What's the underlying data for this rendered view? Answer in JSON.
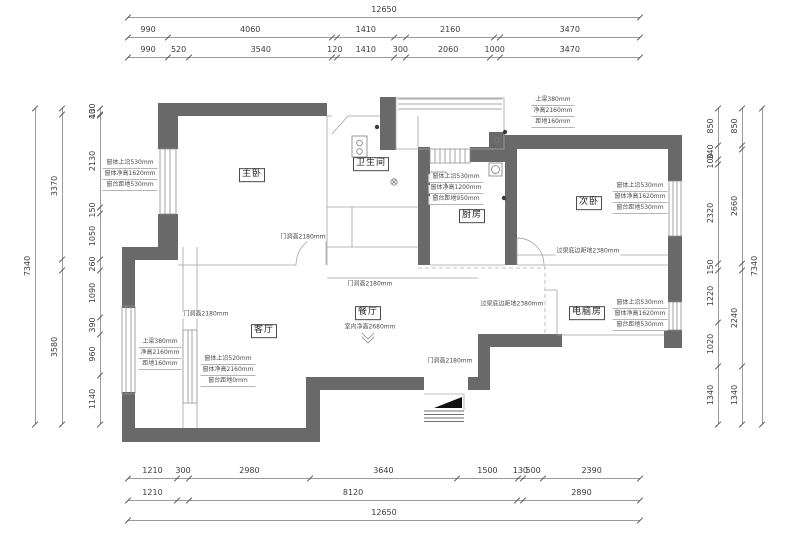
{
  "drawing": {
    "overall_width_mm": "12650",
    "overall_height_mm": "7340"
  },
  "colors": {
    "wall": "#696969",
    "thin_line": "#a3a3a3",
    "dim_line": "#9b9b9b",
    "dim_text": "#3c3c3c",
    "annotation_text": "#4a4a4a"
  },
  "rooms": [
    {
      "name": "master-bedroom",
      "label": "主卧",
      "x": 252,
      "y": 175
    },
    {
      "name": "bathroom",
      "label": "卫生间",
      "x": 371,
      "y": 164
    },
    {
      "name": "kitchen",
      "label": "厨房",
      "x": 472,
      "y": 216
    },
    {
      "name": "second-bedroom",
      "label": "次卧",
      "x": 589,
      "y": 203
    },
    {
      "name": "living-room",
      "label": "客厅",
      "x": 264,
      "y": 331
    },
    {
      "name": "dining-room",
      "label": "餐厅",
      "x": 368,
      "y": 313
    },
    {
      "name": "computer-room",
      "label": "电脑房",
      "x": 587,
      "y": 313
    }
  ],
  "annotations": [
    {
      "name": "master-window",
      "x": 130,
      "y": 160,
      "lines": [
        "窗体上沿530mm",
        "窗体净高1620mm",
        "窗台距地530mm"
      ]
    },
    {
      "name": "kitchen-window",
      "x": 456,
      "y": 174,
      "lines": [
        "窗体上沿530mm",
        "窗体净高1200mm",
        "窗台距地950mm"
      ]
    },
    {
      "name": "second-bedroom-window",
      "x": 640,
      "y": 183,
      "lines": [
        "窗体上沿530mm",
        "窗体净高1620mm",
        "窗台距地530mm"
      ]
    },
    {
      "name": "computer-room-window",
      "x": 640,
      "y": 300,
      "lines": [
        "窗体上沿530mm",
        "窗体净高1620mm",
        "窗台距地530mm"
      ]
    },
    {
      "name": "living-room-beam",
      "x": 160,
      "y": 339,
      "lines": [
        "上梁380mm",
        "净高2160mm",
        "距地160mm"
      ]
    },
    {
      "name": "living-room-window",
      "x": 228,
      "y": 356,
      "lines": [
        "窗体上沿520mm",
        "窗体净高2160mm",
        "窗台距地0mm"
      ]
    },
    {
      "name": "balcony-beam",
      "x": 553,
      "y": 97,
      "lines": [
        "上梁380mm",
        "净高2160mm",
        "距地160mm"
      ]
    }
  ],
  "notes": [
    {
      "name": "door-height-master",
      "label": "门洞高2180mm",
      "x": 303,
      "y": 238
    },
    {
      "name": "door-height-hall",
      "label": "门洞高2180mm",
      "x": 370,
      "y": 285
    },
    {
      "name": "door-height-living",
      "label": "门洞高2180mm",
      "x": 206,
      "y": 315
    },
    {
      "name": "door-height-entry",
      "label": "门洞高2180mm",
      "x": 450,
      "y": 362
    },
    {
      "name": "lintel-clearance-1",
      "label": "过梁底边距地2380mm",
      "x": 588,
      "y": 252
    },
    {
      "name": "lintel-clearance-2",
      "label": "过梁底边距地2380mm",
      "x": 512,
      "y": 305
    },
    {
      "name": "ceiling-height",
      "label": "室内净高2680mm",
      "x": 370,
      "y": 328
    }
  ],
  "dimensions": {
    "top_rows": [
      {
        "name": "top-row-overall",
        "x": 128,
        "y": 6,
        "w": 512,
        "segs": [
          {
            "v": 12650,
            "t": "12650"
          }
        ]
      },
      {
        "name": "top-row-main",
        "x": 128,
        "y": 26,
        "w": 512,
        "segs": [
          {
            "v": 990,
            "t": "990"
          },
          {
            "v": 4060,
            "t": "4060"
          },
          {
            "v": 120,
            "t": ""
          },
          {
            "v": 1410,
            "t": "1410"
          },
          {
            "v": 300,
            "t": ""
          },
          {
            "v": 2160,
            "t": "2160"
          },
          {
            "v": 140,
            "t": ""
          },
          {
            "v": 3470,
            "t": "3470"
          }
        ]
      },
      {
        "name": "top-row-detail",
        "x": 128,
        "y": 46,
        "w": 512,
        "segs": [
          {
            "v": 990,
            "t": "990"
          },
          {
            "v": 520,
            "t": "520"
          },
          {
            "v": 3540,
            "t": "3540"
          },
          {
            "v": 120,
            "t": "120"
          },
          {
            "v": 1410,
            "t": "1410"
          },
          {
            "v": 300,
            "t": "300"
          },
          {
            "v": 2060,
            "t": "2060"
          },
          {
            "v": 240,
            "t": "1000"
          },
          {
            "v": 3470,
            "t": "3470"
          }
        ]
      }
    ],
    "bottom_rows": [
      {
        "name": "bottom-row-detail",
        "x": 128,
        "y": 467,
        "w": 512,
        "segs": [
          {
            "v": 1210,
            "t": "1210"
          },
          {
            "v": 300,
            "t": "300"
          },
          {
            "v": 2980,
            "t": "2980"
          },
          {
            "v": 3640,
            "t": "3640"
          },
          {
            "v": 1500,
            "t": "1500"
          },
          {
            "v": 130,
            "t": "130"
          },
          {
            "v": 500,
            "t": "500"
          },
          {
            "v": 2390,
            "t": "2390"
          }
        ]
      },
      {
        "name": "bottom-row-main",
        "x": 128,
        "y": 489,
        "w": 512,
        "segs": [
          {
            "v": 1210,
            "t": "1210"
          },
          {
            "v": 290,
            "t": ""
          },
          {
            "v": 8120,
            "t": "8120"
          },
          {
            "v": 140,
            "t": ""
          },
          {
            "v": 2890,
            "t": "2890"
          }
        ]
      },
      {
        "name": "bottom-row-overall",
        "x": 128,
        "y": 509,
        "w": 512,
        "segs": [
          {
            "v": 12650,
            "t": "12650"
          }
        ]
      }
    ],
    "left_cols": [
      {
        "name": "left-col-overall",
        "x": 35,
        "y": 108,
        "h": 316,
        "segs": [
          {
            "v": 7340,
            "t": "7340"
          }
        ]
      },
      {
        "name": "left-col-main",
        "x": 62,
        "y": 108,
        "h": 316,
        "segs": [
          {
            "v": 130,
            "t": ""
          },
          {
            "v": 3370,
            "t": "3370"
          },
          {
            "v": 260,
            "t": ""
          },
          {
            "v": 3580,
            "t": "3580"
          }
        ]
      },
      {
        "name": "left-col-detail",
        "x": 100,
        "y": 108,
        "h": 316,
        "segs": [
          {
            "v": 130,
            "t": "130"
          },
          {
            "v": 40,
            "t": "40"
          },
          {
            "v": 2130,
            "t": "2130"
          },
          {
            "v": 150,
            "t": "150"
          },
          {
            "v": 1050,
            "t": "1050"
          },
          {
            "v": 260,
            "t": "260"
          },
          {
            "v": 1090,
            "t": "1090"
          },
          {
            "v": 390,
            "t": "390"
          },
          {
            "v": 960,
            "t": "960"
          },
          {
            "v": 1140,
            "t": "1140"
          }
        ]
      }
    ],
    "right_cols": [
      {
        "name": "right-col-detail",
        "x": 718,
        "y": 108,
        "h": 316,
        "segs": [
          {
            "v": 850,
            "t": "850"
          },
          {
            "v": 340,
            "t": "340"
          },
          {
            "v": 100,
            "t": "100"
          },
          {
            "v": 2320,
            "t": "2320"
          },
          {
            "v": 150,
            "t": "150"
          },
          {
            "v": 1220,
            "t": "1220"
          },
          {
            "v": 1020,
            "t": "1020"
          },
          {
            "v": 1340,
            "t": "1340"
          }
        ]
      },
      {
        "name": "right-col-main",
        "x": 742,
        "y": 108,
        "h": 316,
        "segs": [
          {
            "v": 850,
            "t": "850"
          },
          {
            "v": 100,
            "t": ""
          },
          {
            "v": 2660,
            "t": "2660"
          },
          {
            "v": 150,
            "t": ""
          },
          {
            "v": 2240,
            "t": "2240"
          },
          {
            "v": 1340,
            "t": "1340"
          }
        ]
      },
      {
        "name": "right-col-overall",
        "x": 762,
        "y": 108,
        "h": 316,
        "segs": [
          {
            "v": 7340,
            "t": "7340"
          }
        ]
      }
    ]
  }
}
